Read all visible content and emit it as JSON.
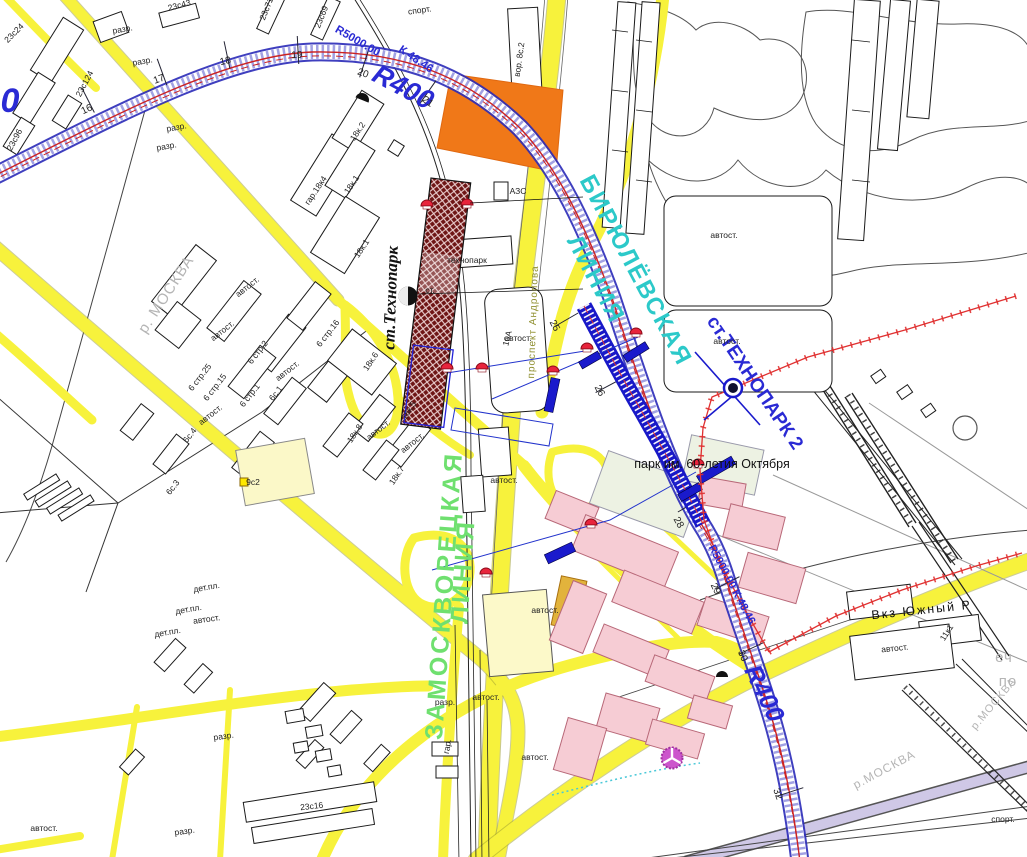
{
  "colors": {
    "road_yellow": "#f7f23c",
    "metro_band_blue": "#2a2ab8",
    "construction_blue": "#1818c8",
    "axis_red": "#cc2222",
    "boundary_red": "#e03030",
    "parcel_orange": "#f07818",
    "station_hatch": "#6e1515",
    "line_biryulyovskaya_text": "#2cc9c9",
    "line_zamoskvoretskaya_text": "#6fe06f",
    "blue_label": "#2a2ad4",
    "pink_building": "#f6ccd4",
    "watermark_gray": "#b5b5b5"
  },
  "line_labels": [
    "БИРЮЛЁВСКАЯ",
    "ЛИНИЯ",
    "ЗАМОСКВОРЕЦКАЯ",
    "ЛИНИЯ"
  ],
  "station_labels": [
    "ст.Технопарк",
    "ст.ТЕХНОПАРК 2",
    "ст."
  ],
  "radius_labels": [
    "R400",
    "R5000.00",
    "К 48.46",
    "R400",
    "R5000.00  К 48.46",
    "0"
  ],
  "chainage_labels": [
    "16",
    "17",
    "18",
    "19",
    "20",
    "21",
    "25",
    "26",
    "28",
    "29",
    "30",
    "32"
  ],
  "street_labels": [
    "проспект Андропова"
  ],
  "place_labels": [
    "парк им. 60-летия Октября",
    "Вкз Южный Р",
    "технопарк",
    "АЗС"
  ],
  "watermark_labels": [
    "р. МОСКВА",
    "р.МОСКВА",
    "еч",
    "по",
    "р.МОСКВА"
  ],
  "autost_labels": [
    "автост.",
    "автост.",
    "автост.",
    "автост.",
    "автост.",
    "автост.",
    "автост.",
    "автост.",
    "автост.",
    "автост.",
    "автост.",
    "автост.",
    "автост.",
    "автост.",
    "автост.",
    "автост."
  ],
  "building_labels": [
    "спорт.",
    "вор. 8с.2",
    "23с43",
    "23с71",
    "23с69",
    "23с124",
    "23с24",
    "23с96",
    "разр.",
    "разр.",
    "разр.",
    "разр.",
    "гар.18к4",
    "18к.2",
    "18к.1",
    "18к.1",
    "18к.6",
    "18к.5",
    "18к.8",
    "18к.7",
    "6 стр.25",
    "6 стр.15",
    "6 стр.2",
    "6 стр.1",
    "6 стр.16",
    "6с.4",
    "6с.3",
    "6с.1",
    "9с2",
    "дет.пл.",
    "дет.пл.",
    "дет.пл.",
    "23с16",
    "разр.",
    "разр.",
    "разр.",
    "гар.",
    "10А",
    "11к1",
    "спорт."
  ]
}
